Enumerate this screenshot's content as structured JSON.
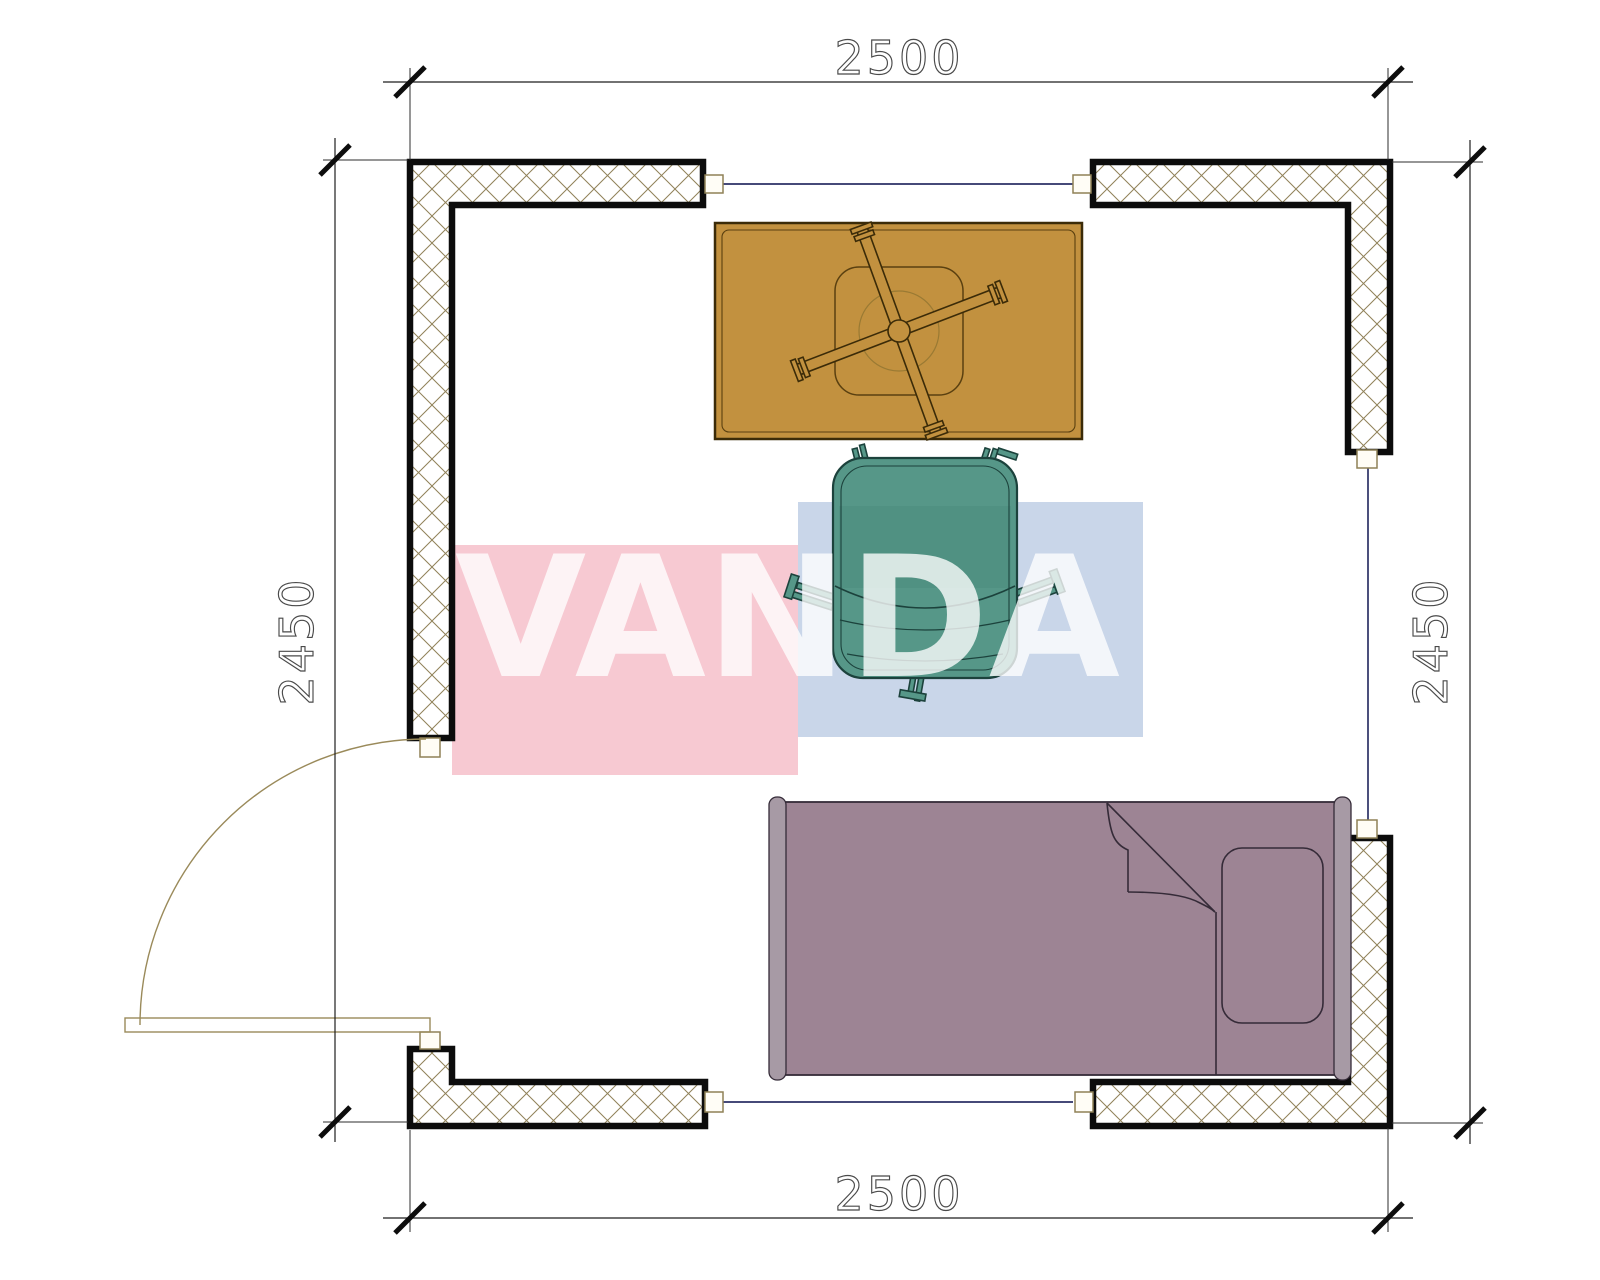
{
  "title": "room-floor-plan",
  "dimensions": {
    "top": "2500",
    "bottom": "2500",
    "left": "2450",
    "right": "2450"
  },
  "watermark": {
    "text": "VANDA",
    "pink_block": "#f7c9d2",
    "blue_block": "#c9d6e9",
    "letter_color": "#ffffff"
  },
  "colors": {
    "wall_border": "#0c0c0c",
    "wall_hatch": "#8f8157",
    "window_line": "#2c3166",
    "door_line": "#9a8a5a",
    "dimension_text": "#4a4a4a",
    "desk": "#c2913f",
    "desk_outline": "#3b2b08",
    "chair": "#569788",
    "chair_outline": "#1c423c",
    "bed": "#9d8494",
    "bed_rail": "#a79aa5",
    "bed_outline": "#352b38"
  }
}
